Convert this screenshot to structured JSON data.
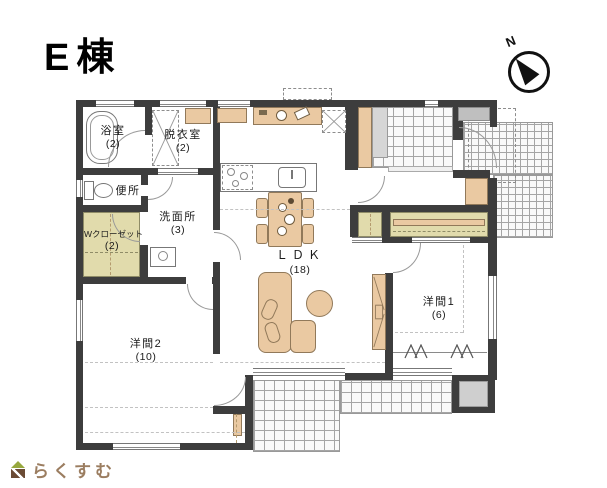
{
  "title": "E棟",
  "compass": {
    "label": "N"
  },
  "logo": {
    "text": "らくすむ"
  },
  "rooms": [
    {
      "id": "bath",
      "label": "浴室",
      "size": "(2)"
    },
    {
      "id": "dressing",
      "label": "脱衣室",
      "size": "(2)"
    },
    {
      "id": "toilet",
      "label": "便所",
      "size": ""
    },
    {
      "id": "wcloset",
      "label": "Wクローゼット",
      "size": "(2)"
    },
    {
      "id": "washroom",
      "label": "洗面所",
      "size": "(3)"
    },
    {
      "id": "ldk",
      "label": "ＬＤＫ",
      "size": "(18)"
    },
    {
      "id": "yoshitsu1",
      "label": "洋間1",
      "size": "(6)"
    },
    {
      "id": "yoshitsu2",
      "label": "洋間2",
      "size": "(10)"
    }
  ],
  "colors": {
    "wall": "#3d3d3d",
    "furniture_tan": "#eac9a2",
    "closet_khaki": "#e1dbac",
    "logo_green": "#97a83e",
    "logo_brown": "#6b4b35",
    "logo_text": "#9b7d60"
  }
}
